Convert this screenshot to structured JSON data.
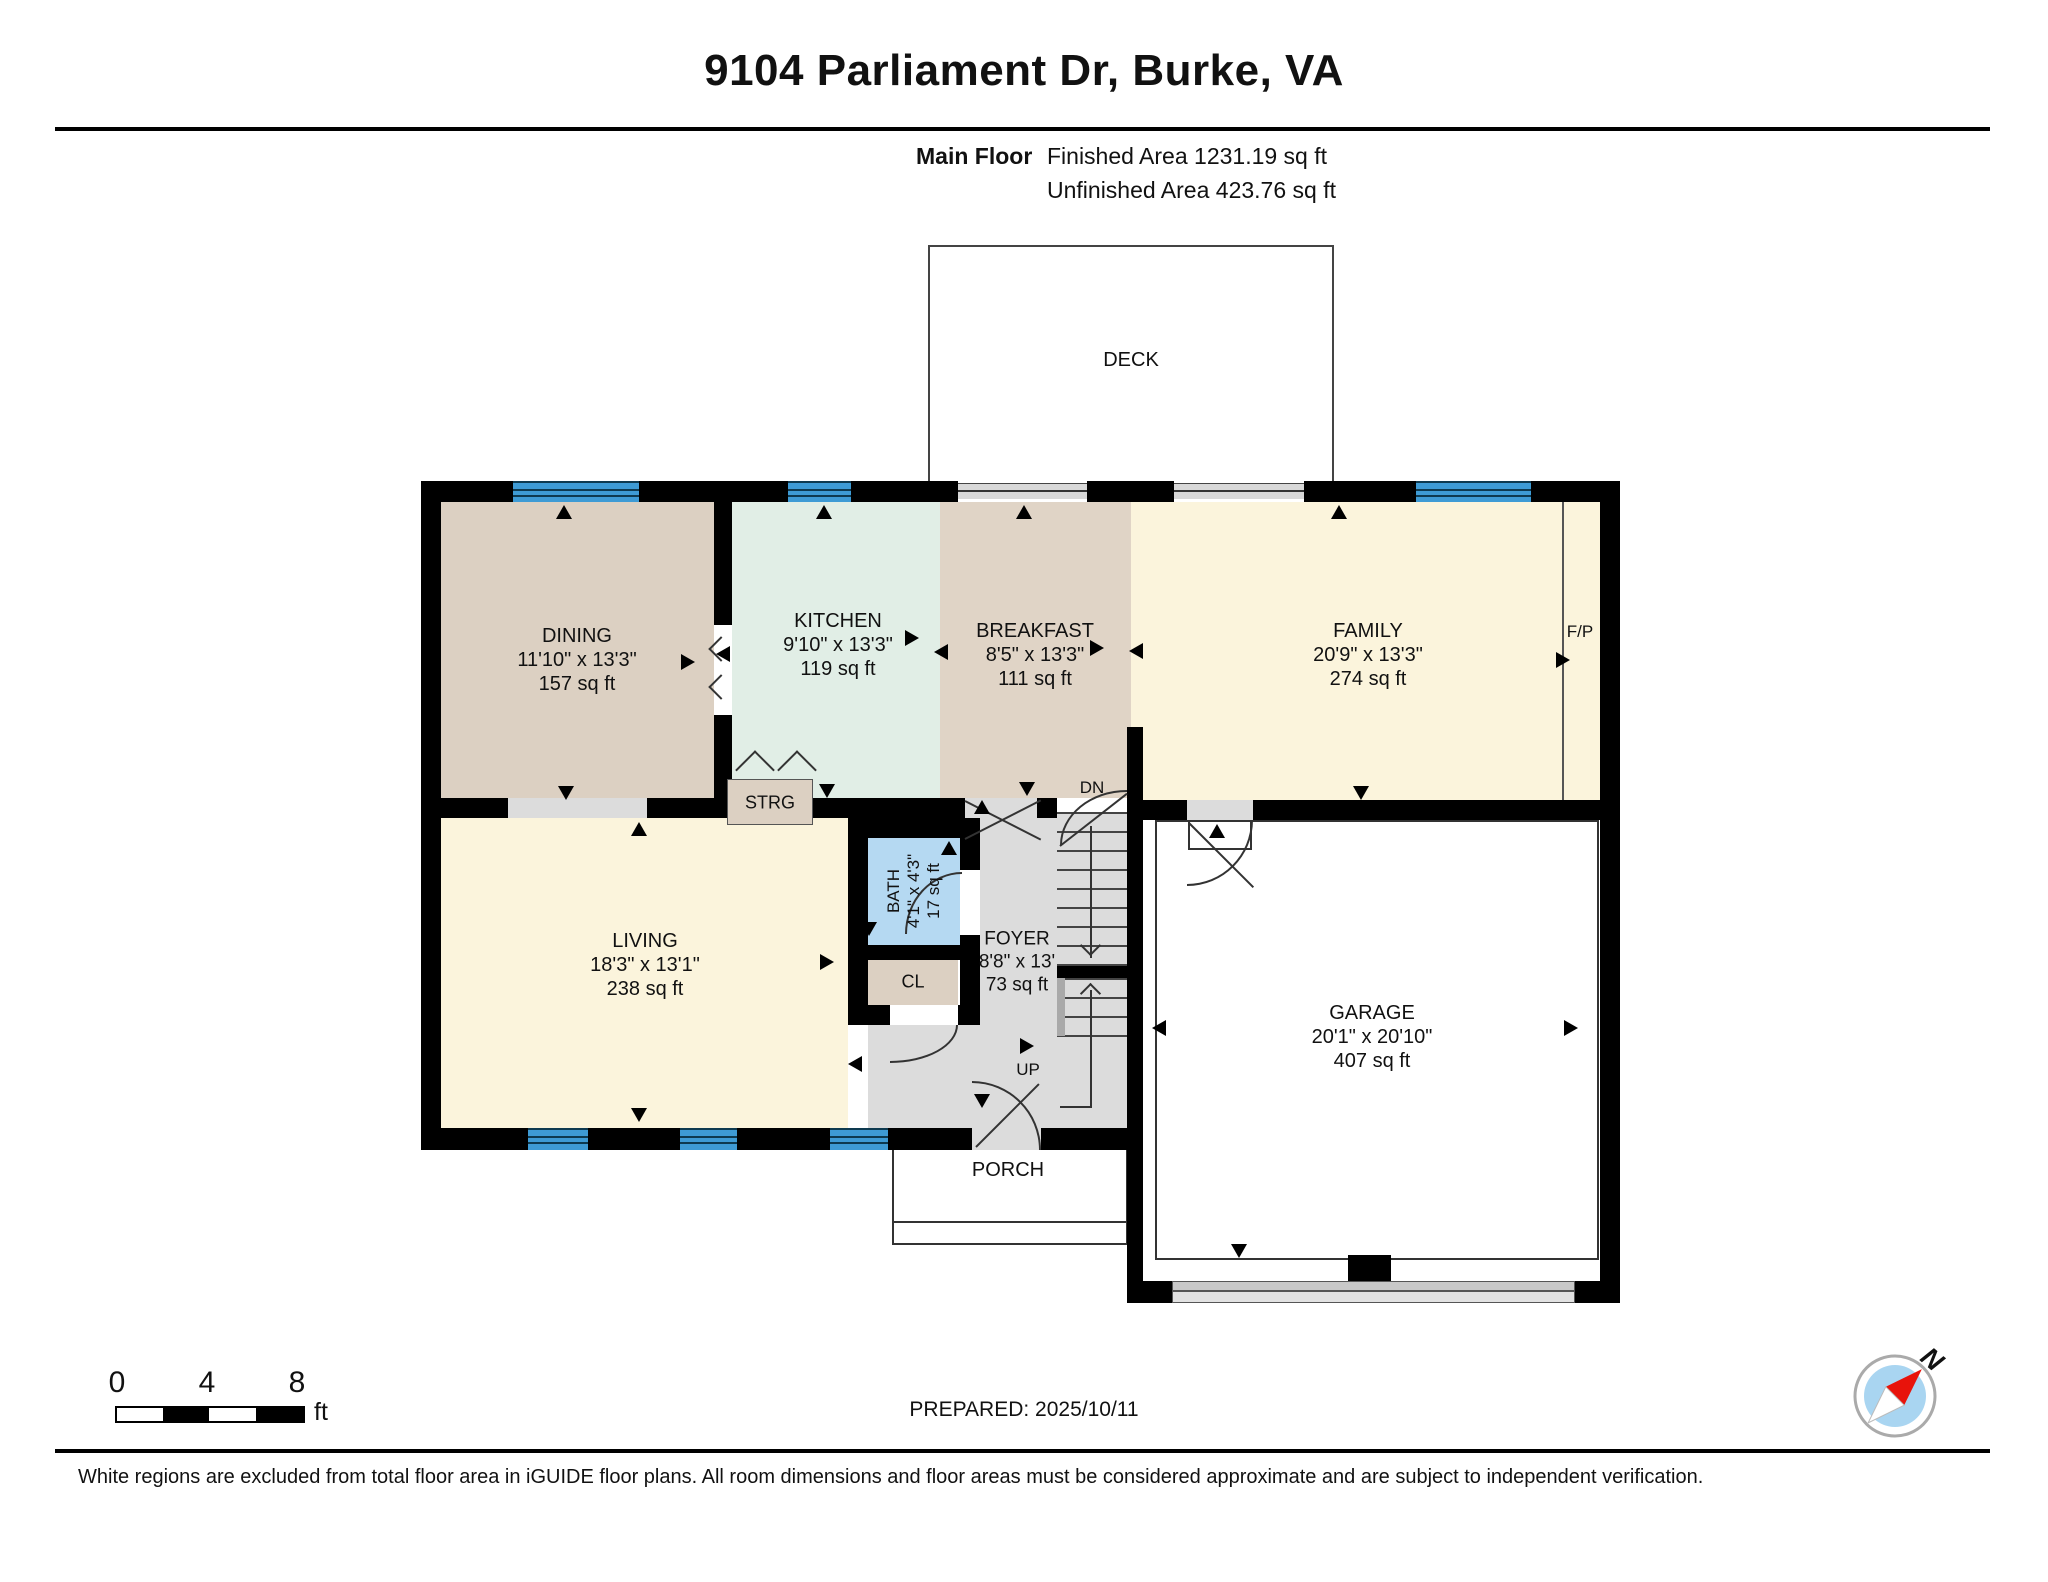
{
  "header": {
    "title": "9104 Parliament Dr, Burke, VA",
    "floor_label": "Main Floor",
    "finished_area": "Finished Area 1231.19 sq ft",
    "unfinished_area": "Unfinished Area 423.76 sq ft"
  },
  "rooms": {
    "deck": {
      "name": "DECK"
    },
    "dining": {
      "name": "DINING",
      "dimensions": "11'10\" x 13'3\"",
      "area": "157 sq ft"
    },
    "kitchen": {
      "name": "KITCHEN",
      "dimensions": "9'10\" x 13'3\"",
      "area": "119 sq ft"
    },
    "breakfast": {
      "name": "BREAKFAST",
      "dimensions": "8'5\" x 13'3\"",
      "area": "111 sq ft"
    },
    "family": {
      "name": "FAMILY",
      "dimensions": "20'9\" x 13'3\"",
      "area": "274 sq ft"
    },
    "living": {
      "name": "LIVING",
      "dimensions": "18'3\" x 13'1\"",
      "area": "238 sq ft"
    },
    "bath": {
      "name": "BATH",
      "dimensions": "4'1\" x 4'3\"",
      "area": "17 sq ft"
    },
    "foyer": {
      "name": "FOYER",
      "dimensions": "8'8\" x 13'",
      "area": "73 sq ft"
    },
    "garage": {
      "name": "GARAGE",
      "dimensions": "20'1\" x 20'10\"",
      "area": "407 sq ft"
    },
    "porch": {
      "name": "PORCH"
    },
    "storage": {
      "name": "STRG"
    },
    "closet": {
      "name": "CL"
    }
  },
  "annotations": {
    "fireplace": "F/P",
    "stairs_down": "DN",
    "stairs_up": "UP"
  },
  "scale_bar": {
    "tick_0": "0",
    "tick_4": "4",
    "tick_8": "8",
    "unit": "ft"
  },
  "prepared": "PREPARED: 2025/10/11",
  "compass": {
    "north_label": "N"
  },
  "footer": "White regions are excluded from total floor area in iGUIDE floor plans. All room dimensions and floor areas must be considered approximate and are subject to independent verification.",
  "colors": {
    "wall": "#000000",
    "window_blue": "#3E9BD5",
    "floor_tan": "#DCD0C2",
    "floor_mint": "#E1EEE6",
    "floor_cream": "#FBF4DC",
    "floor_gray": "#DCDCDC",
    "bath_blue": "#B5D9F2",
    "compass_needle": "#E8130B",
    "compass_inner": "#A9D5F1"
  }
}
